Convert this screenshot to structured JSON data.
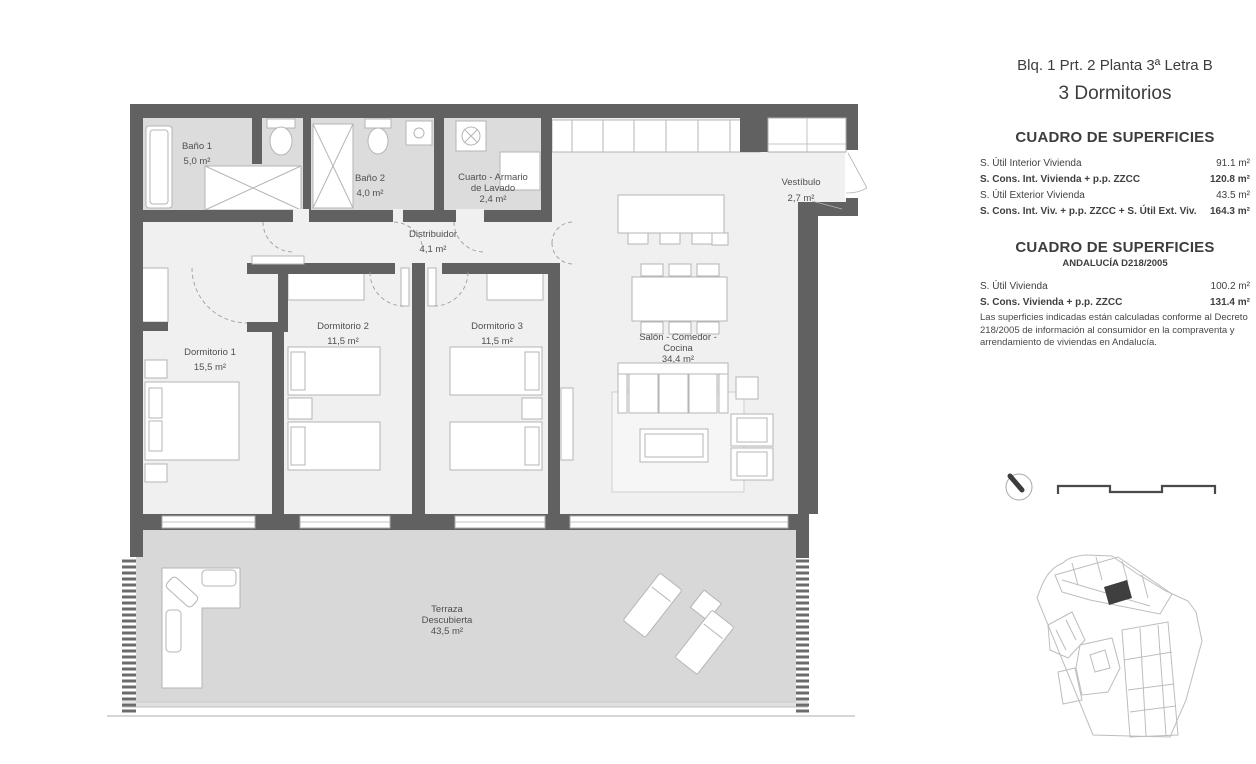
{
  "header": {
    "subtitle": "Blq. 1 Prt. 2 Planta 3ª Letra B",
    "title": "3 Dormitorios"
  },
  "tables": {
    "t1": {
      "title": "CUADRO DE SUPERFICIES",
      "rows": [
        {
          "label": "S. Útil Interior Vivienda",
          "value": "91.1 m²"
        },
        {
          "label": "S. Cons. Int. Vivienda + p.p. ZZCC",
          "value": "120.8 m²"
        },
        {
          "label": "S. Útil Exterior Vivienda",
          "value": "43.5 m²"
        },
        {
          "label": "S. Cons. Int. Viv. + p.p. ZZCC + S. Útil Ext. Viv.",
          "value": "164.3 m²"
        }
      ]
    },
    "t2": {
      "title": "CUADRO DE SUPERFICIES",
      "subtitle": "ANDALUCÍA D218/2005",
      "rows": [
        {
          "label": "S. Útil Vivienda",
          "value": "100.2 m²"
        },
        {
          "label": "S. Cons. Vivienda + p.p. ZZCC",
          "value": "131.4 m²"
        }
      ],
      "note": "Las superficies indicadas están calculadas conforme al Decreto 218/2005 de información al consumidor en la compraventa y arrendamiento de viviendas en Andalucía."
    }
  },
  "plan": {
    "rooms": {
      "bano1": {
        "line1": "Baño 1",
        "area": "5,0 m²"
      },
      "bano2": {
        "line1": "Baño 2",
        "area": "4,0 m²"
      },
      "lavado": {
        "line1": "Cuarto - Armario",
        "line2": "de Lavado",
        "area": "2,4 m²"
      },
      "vestibulo": {
        "line1": "Vestíbulo",
        "area": "2,7 m²"
      },
      "distribuidor": {
        "line1": "Distribuidor",
        "area": "4,1 m²"
      },
      "dorm1": {
        "line1": "Dormitorio 1",
        "area": "15,5 m²"
      },
      "dorm2": {
        "line1": "Dormitorio 2",
        "area": "11,5 m²"
      },
      "dorm3": {
        "line1": "Dormitorio 3",
        "area": "11,5 m²"
      },
      "salon": {
        "line1": "Salón - Comedor -",
        "line2": "Cocina",
        "area": "34,4 m²"
      },
      "terraza": {
        "line1": "Terraza",
        "line2": "Descubierta",
        "area": "43,5 m²"
      }
    },
    "colors": {
      "wall": "#616161",
      "interior_floor": "#f0f0f0",
      "bath_floor": "#dcdcdc",
      "terrace_floor": "#d8d8d8",
      "site_unit_fill": "#3f3f3f"
    },
    "icons": [
      "north-compass-icon",
      "scale-bar",
      "site-plan-map",
      "extractor-fan-icon"
    ]
  }
}
